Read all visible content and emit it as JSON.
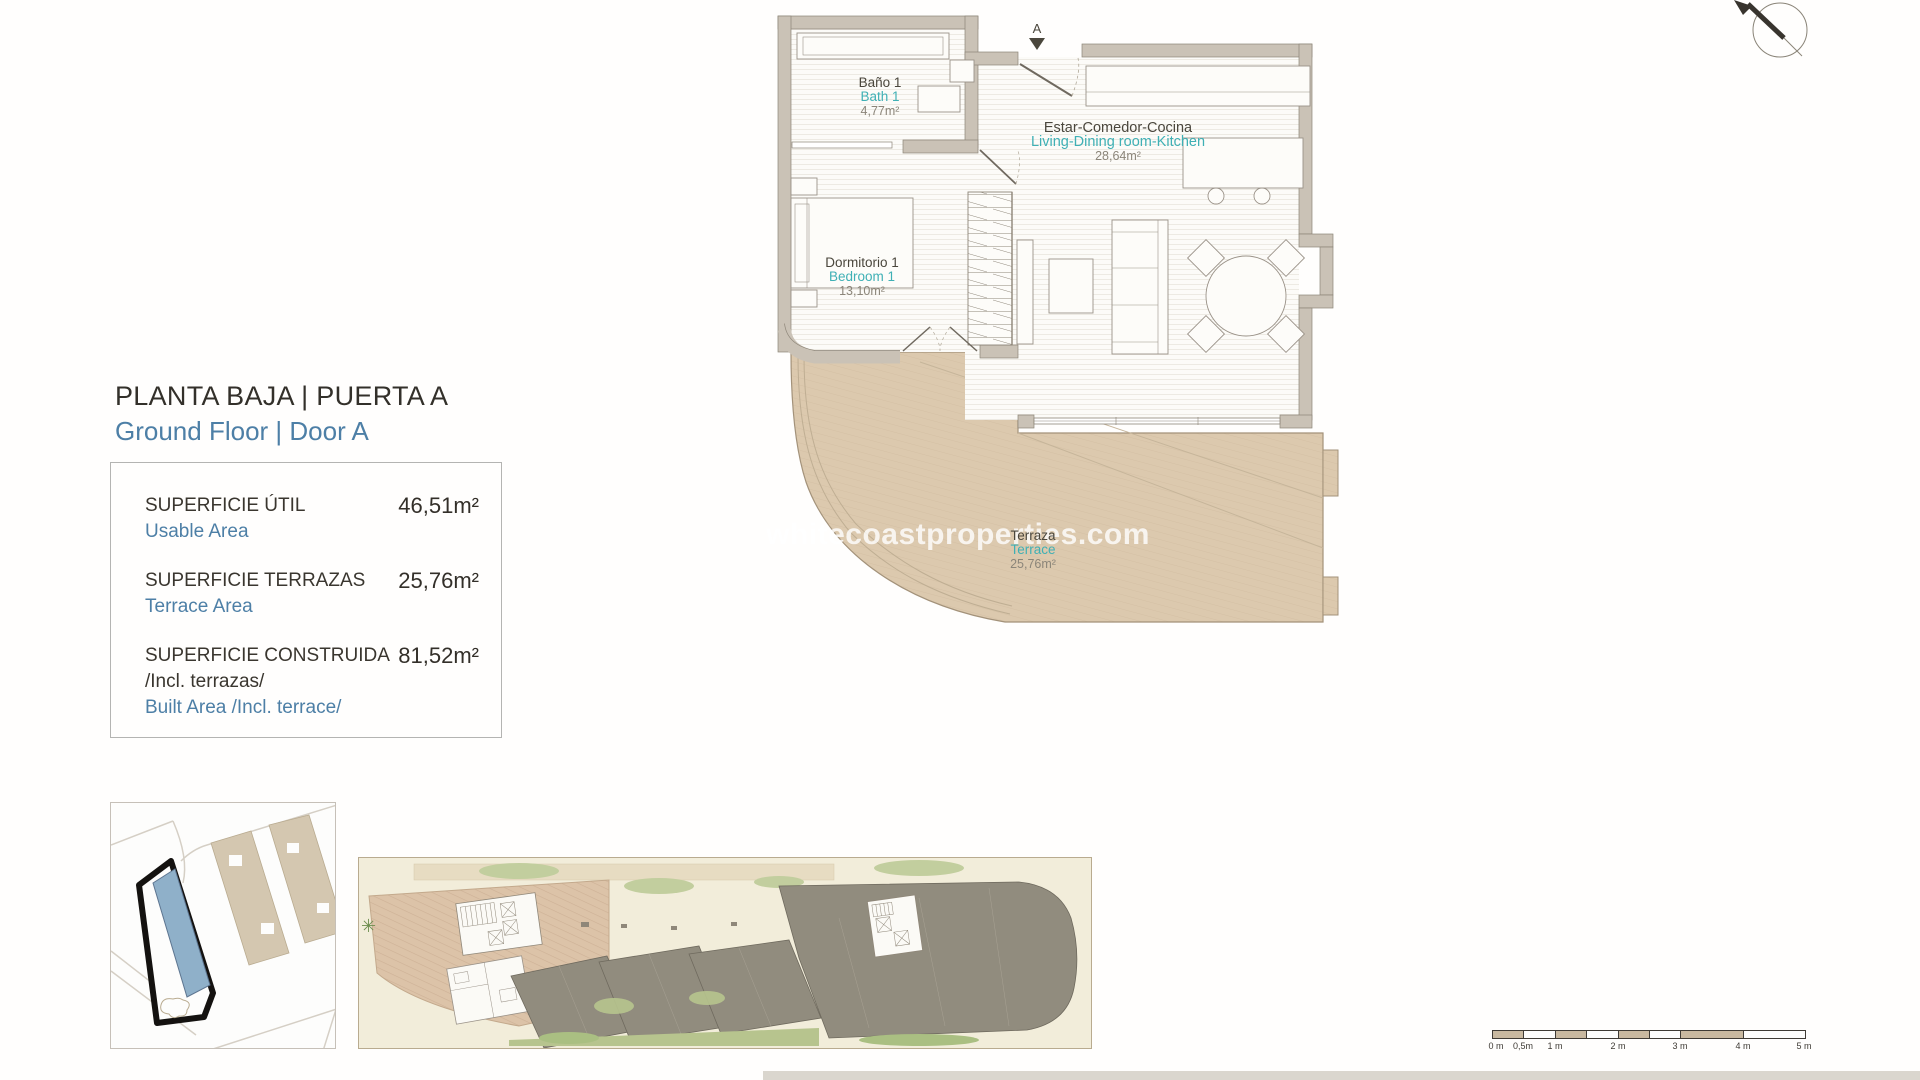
{
  "header": {
    "title_es": "PLANTA BAJA | PUERTA A",
    "title_en": "Ground Floor | Door A"
  },
  "area_table": {
    "rows": [
      {
        "label_es": "SUPERFICIE ÚTIL",
        "label_es_extra": "",
        "label_en": "Usable Area",
        "value": "46,51m²"
      },
      {
        "label_es": "SUPERFICIE TERRAZAS",
        "label_es_extra": "",
        "label_en": "Terrace Area",
        "value": "25,76m²"
      },
      {
        "label_es": "SUPERFICIE CONSTRUIDA",
        "label_es_extra": "/Incl. terrazas/",
        "label_en": "Built Area /Incl. terrace/",
        "value": "81,52m²"
      }
    ]
  },
  "floor_plan": {
    "entrance_label": "A",
    "watermark": "whitecoastproperties.com",
    "rooms": {
      "bath": {
        "es": "Baño 1",
        "en": "Bath 1",
        "area": "4,77m²"
      },
      "living": {
        "es": "Estar-Comedor-Cocina",
        "en": "Living-Dining room-Kitchen",
        "area": "28,64m²"
      },
      "bedroom": {
        "es": "Dormitorio 1",
        "en": "Bedroom 1",
        "area": "13,10m²"
      },
      "terrace": {
        "es": "Terraza",
        "en": "Terrace",
        "area": "25,76m²"
      }
    }
  },
  "scale_bar": {
    "labels": [
      "0 m",
      "0,5m",
      "1 m",
      "2 m",
      "3 m",
      "4 m",
      "5 m"
    ]
  },
  "colors": {
    "accent_blue": "#4d7fa6",
    "accent_teal": "#3fb0b5",
    "wall": "#cac2b6",
    "terrace_tan": "#dcc9ae",
    "site_gray": "#918c7e",
    "highlight_blue": "#8fb0c9",
    "text_dark": "#33302a"
  }
}
